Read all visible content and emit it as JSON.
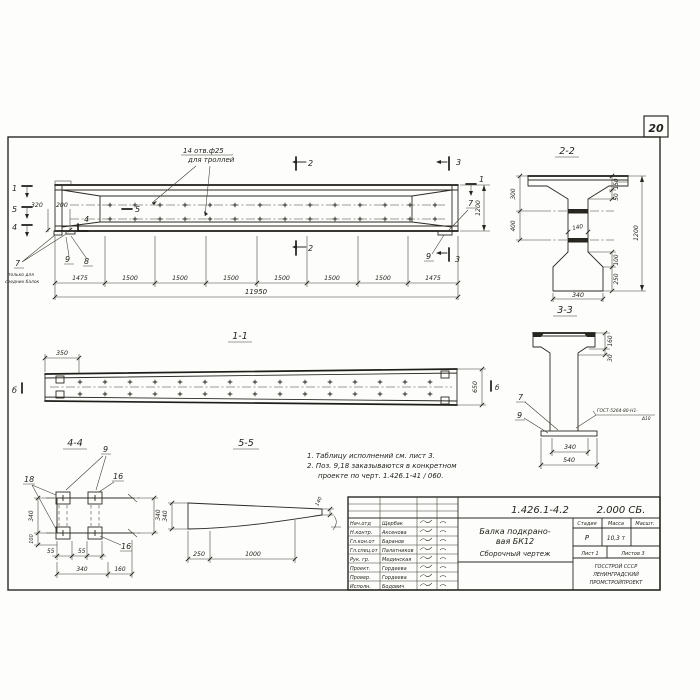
{
  "page": {
    "sheet_number": "20",
    "ink": "#2b2923",
    "paper": "#fdfdfb"
  },
  "main_view": {
    "callout": {
      "line1": "14 отв.ф25",
      "line2": "для троллей"
    },
    "left_markers": {
      "m1": "1",
      "m5": "5",
      "m4": "4"
    },
    "inner_markers": {
      "m5": "5",
      "m4": "4"
    },
    "right_markers": {
      "m1": "1",
      "m2": "2",
      "m3": "3"
    },
    "pos_labels": {
      "p7": "7",
      "p8": "8",
      "p9": "9",
      "p7r": "7",
      "p9r": "9"
    },
    "pos7_note": {
      "line1": "только для",
      "line2": "средних балок"
    },
    "dims": {
      "d320": "320",
      "d200": "200",
      "height": "1200",
      "chain": [
        "1475",
        "1500",
        "1500",
        "1500",
        "1500",
        "1500",
        "1500",
        "1475"
      ],
      "total": "11950"
    }
  },
  "section22": {
    "title": "2-2",
    "dims": {
      "left1": "300",
      "left2": "400",
      "web": "140",
      "r1": "150",
      "r2": "50",
      "r3": "1200",
      "r4": "100",
      "r5": "250",
      "bottom": "340"
    }
  },
  "section33": {
    "title": "3-3",
    "labels": {
      "p7": "7",
      "p9": "9"
    },
    "weld": {
      "line1": "ГОСТ-5264-80-Н1-",
      "line2": "Δ10"
    },
    "dims": {
      "r1": "160",
      "r2": "30",
      "b1": "340",
      "b2": "540"
    }
  },
  "view11": {
    "title": "1-1",
    "markers": {
      "left": "б",
      "right": "б"
    },
    "dims": {
      "left": "350",
      "right": "650"
    }
  },
  "section44": {
    "title": "4-4",
    "labels": {
      "p9": "9",
      "p18": "18",
      "p16a": "16",
      "p16b": "16"
    },
    "dims": {
      "l1": "340",
      "l2": "100",
      "b1": "55",
      "b2": "55",
      "b3": "340",
      "b4": "160",
      "r": "340"
    }
  },
  "section55": {
    "title": "5-5",
    "dims": {
      "left": "340",
      "b1": "250",
      "b2": "1000",
      "right": "140"
    }
  },
  "notes": {
    "line1": "1. Таблицу исполнений см. лист 3.",
    "line2": "2. Поз. 9,18 заказываются в конкретном",
    "line3": "проекте по черт. 1.426.1-41 / 060."
  },
  "title_block": {
    "doc_number": "1.426.1-4.2",
    "doc_code": "2.000 СБ.",
    "title1": "Балка подкрано-",
    "title2": "вая БК12",
    "title3": "Сборочный чертеж",
    "staff": [
      {
        "role": "Нач.отд",
        "name": "Щербак"
      },
      {
        "role": "Н.контр.",
        "name": "Аксенова"
      },
      {
        "role": "Гл.кон.от",
        "name": "Баранов"
      },
      {
        "role": "Гл.спец.от",
        "name": "Палатников"
      },
      {
        "role": "Рук. гр.",
        "name": "Мединская"
      },
      {
        "role": "Проект.",
        "name": "Гордеева"
      },
      {
        "role": "Провер.",
        "name": "Гордеева"
      },
      {
        "role": "Исполн.",
        "name": "Бодович"
      }
    ],
    "stage_header": "Стадия",
    "mass_header": "Масса",
    "scale_header": "Масшт.",
    "stage": "Р",
    "mass": "10,3 т",
    "sheet": "Лист 1",
    "sheets": "Листов 3",
    "org1": "ГОССТРОЙ СССР",
    "org2": "ЛЕНИНГРАДСКИЙ",
    "org3": "ПРОМСТРОЙПРОЕКТ"
  }
}
